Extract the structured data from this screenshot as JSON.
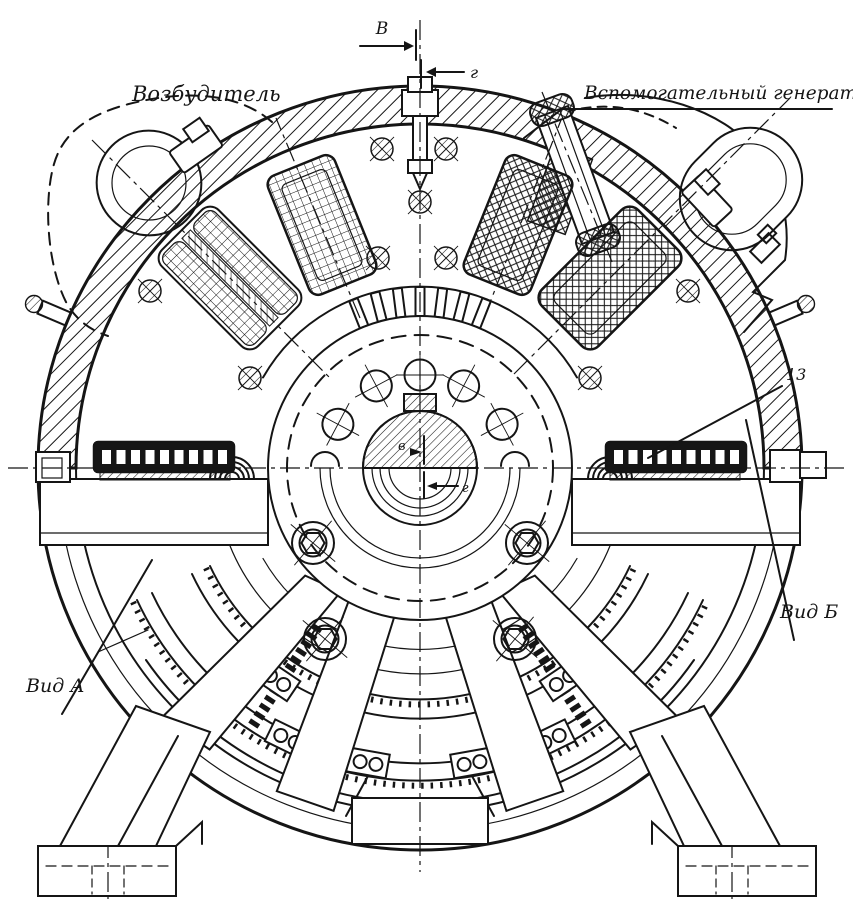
{
  "drawing": {
    "components": {
      "exciter": "Возбудитель",
      "aux_generator": "Вспомогательный генератор"
    },
    "views": {
      "view_a": "Вид А",
      "view_b": "Вид Б"
    },
    "callouts": {
      "part_number": "13"
    },
    "section_marks": {
      "top_b": "В",
      "top_g": "г",
      "center_b": "в",
      "center_g": "г"
    },
    "colors": {
      "ink": "#151515",
      "paper": "#ffffff"
    }
  }
}
